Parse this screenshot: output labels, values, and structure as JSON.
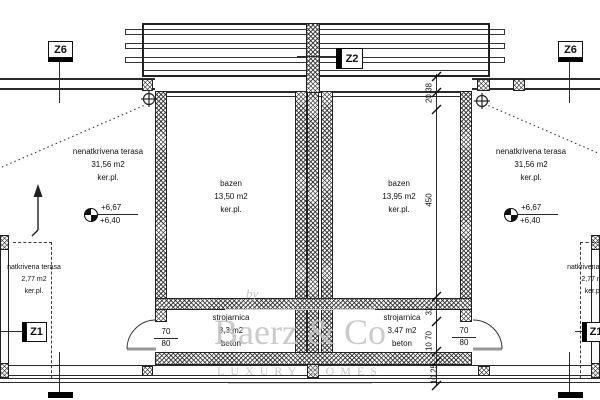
{
  "markers": {
    "z6": "Z6",
    "z2": "Z2",
    "z1": "Z1"
  },
  "rooms": {
    "terrace_open_left": {
      "name": "nenatkrivena terasa",
      "area": "31,56 m2",
      "finish": "ker.pl."
    },
    "terrace_open_right": {
      "name": "nenatkrivena terasa",
      "area": "31,56 m2",
      "finish": "ker.pl."
    },
    "pool_left": {
      "name": "bazen",
      "area": "13,50 m2",
      "finish": "ker.pl."
    },
    "pool_right": {
      "name": "bazen",
      "area": "13,95 m2",
      "finish": "ker.pl."
    },
    "plant_left": {
      "name": "strojarnica",
      "area": "3,3 m2",
      "finish": "beton"
    },
    "plant_right": {
      "name": "strojarnica",
      "area": "3,47 m2",
      "finish": "beton"
    },
    "terrace_covered_left": {
      "name": "natkrivena terasa",
      "area": "2,77 m2",
      "finish": "ker.pl."
    },
    "terrace_covered_right": {
      "name": "natkrivena terasa",
      "area": "2,77 m2",
      "finish": "ker.pl."
    }
  },
  "levels": {
    "upper": "+6,67",
    "lower": "+6,40"
  },
  "dimensions": {
    "top_offsets": "20,38",
    "pool_length": "450",
    "wall_section": "32",
    "door_opening": "10 70",
    "edge_band": "10,25",
    "door_width": "70",
    "door_height": "80"
  },
  "watermark": {
    "prefix": "by",
    "brand": "Baerz & Co",
    "tagline": "LUXURY HOMES"
  },
  "colors": {
    "line": "#2b2b2b",
    "watermark": "#c3c3c3",
    "background": "#ffffff"
  }
}
